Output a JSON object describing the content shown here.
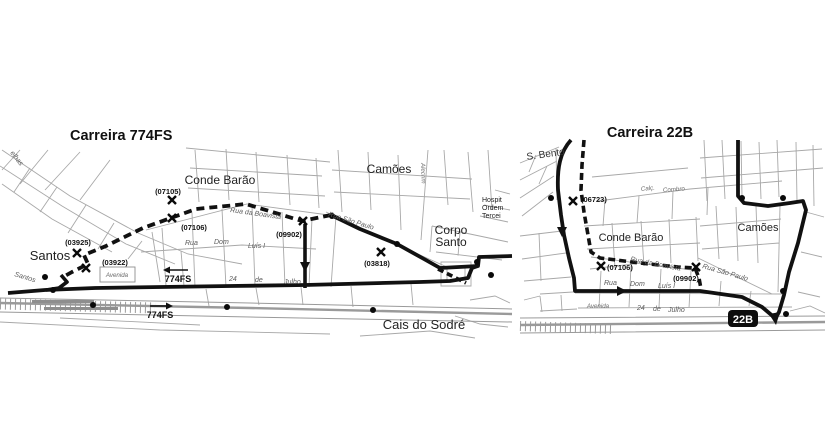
{
  "left_map": {
    "title": "Carreira 774FS",
    "places": {
      "conde_barao": "Conde Barão",
      "camoes": "Camões",
      "corpo_santo_line1": "Corpo",
      "corpo_santo_line2": "Santo",
      "santos": "Santos",
      "cais_do_sodre": "Cais do Sodré",
      "hospital_line1": "Hospit",
      "hospital_line2": "Ordem",
      "hospital_line3": "Tercei"
    },
    "stop_codes": {
      "c07105": "(07105)",
      "c07106": "(07106)",
      "c09902": "(09902)",
      "c03925": "(03925)",
      "c03922": "(03922)",
      "c03818": "(03818)"
    },
    "streets": {
      "boavista": "Rua  da  Boavista",
      "dom_luis_rua": "Rua",
      "dom_luis_dom": "Dom",
      "dom_luis_luis": "Luís  I",
      "sao_paulo": "Rua São Paulo",
      "avenida": "Avenida",
      "julho_24": "24",
      "julho_de": "de",
      "julho_julho": "Julho",
      "santos_street": "Santos",
      "velhas_fragment": "elhas",
      "alecrim": "Alecrim"
    },
    "direction_labels": {
      "west": "774FS",
      "east": "774FS"
    }
  },
  "right_map": {
    "title": "Carreira 22B",
    "badge": "22B",
    "places": {
      "s_bento": "S. Bento",
      "conde_barao": "Conde Barão",
      "camoes": "Camões"
    },
    "stop_codes": {
      "c06723": "(06723)",
      "c07106": "(07106)",
      "c09902": "(09902)"
    },
    "streets": {
      "boavista": "Rua  da  Boavista",
      "dom_luis_rua": "Rua",
      "dom_luis_dom": "Dom",
      "dom_luis_luis": "Luís  I",
      "sao_paulo": "Rua São Paulo",
      "avenida": "Avenida",
      "julho_24": "24",
      "julho_de": "de",
      "julho_julho": "Julho",
      "combro_calc": "Calç.",
      "combro_name": "Combro"
    }
  },
  "colors": {
    "route": "#111111",
    "street": "#a8a8a8",
    "background": "#ffffff"
  }
}
